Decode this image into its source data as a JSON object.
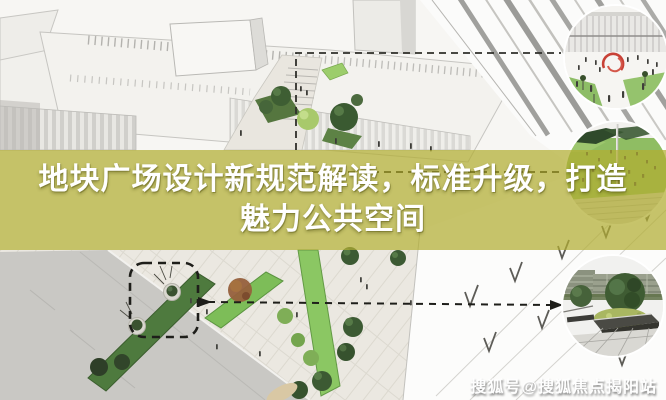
{
  "title": {
    "line1": "地块广场设计新规范解读，标准升级，打造",
    "line2": "魅力公共空间"
  },
  "watermark": {
    "text": "搜狐号@搜狐焦点揭阳站"
  },
  "colors": {
    "band_overlay": "rgba(177,173,50,0.72)",
    "title_text": "#ffffff",
    "watermark_text": "#ffffff",
    "sculpture_red": "#c84136",
    "lawn_dark": "#4e7a3e",
    "lawn_light": "#7dbd58",
    "annotation_ink": "#22221d",
    "paving": "#eceae3",
    "road_gray": "#c9c8c4"
  }
}
